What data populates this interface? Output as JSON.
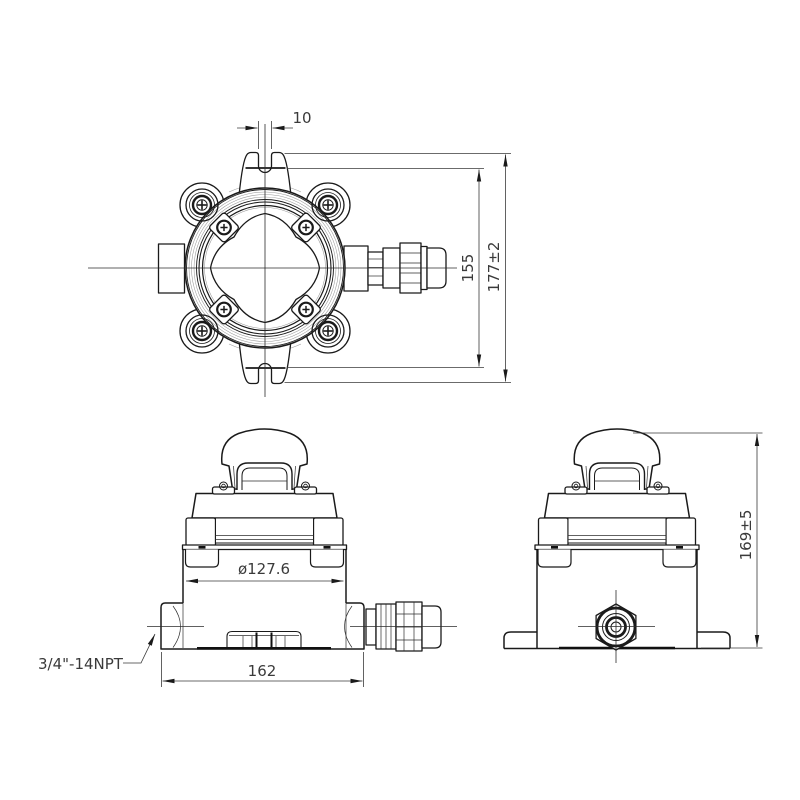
{
  "drawing": {
    "background": "#ffffff",
    "line_color": "#1a1a1a",
    "views": {
      "top": {
        "dimensions": {
          "slot_width": "10",
          "inner_height": "155",
          "overall_height": "177±2"
        }
      },
      "front": {
        "dimensions": {
          "body_diameter": "ø127.6",
          "flange_width": "162"
        },
        "thread_label": "3/4\"-14NPT"
      },
      "side": {
        "dimensions": {
          "overall_height": "169±5"
        }
      }
    }
  }
}
